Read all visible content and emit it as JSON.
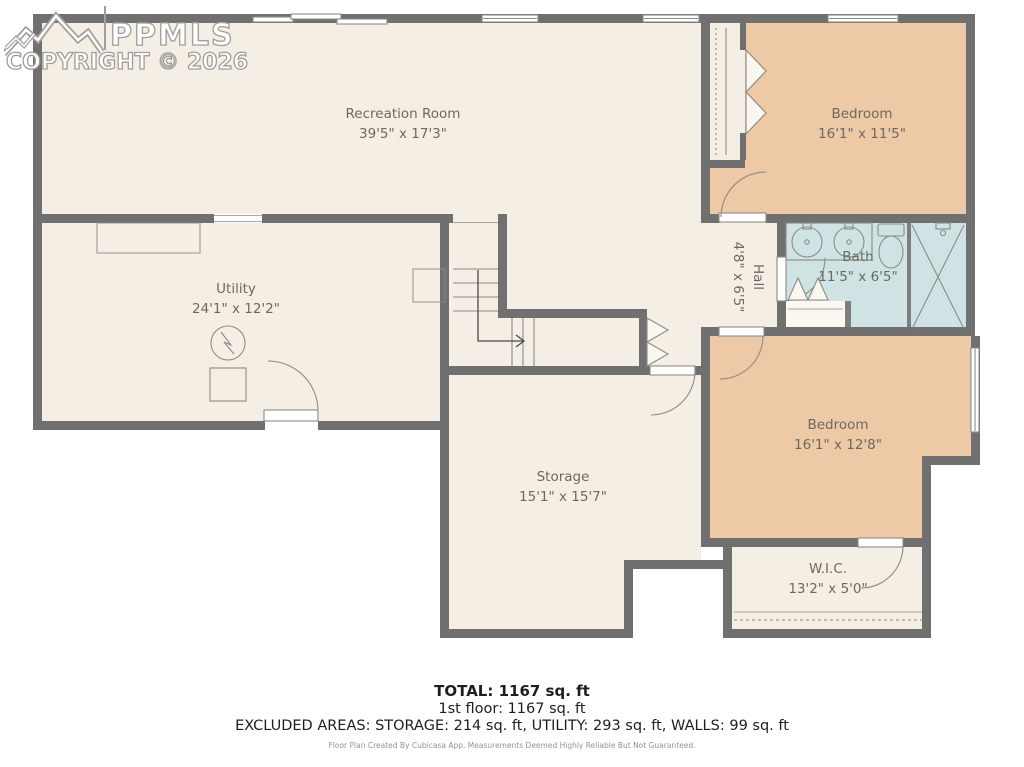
{
  "watermark": {
    "logo_icon": "mountain-peaks-icon",
    "brand": "PPMLS",
    "copyright": "COPYRIGHT © 2026"
  },
  "floor_plan": {
    "rooms": [
      {
        "name": "Recreation Room",
        "dims": "39'5\" x 17'3\""
      },
      {
        "name": "Bedroom",
        "dims": "16'1\" x 11'5\""
      },
      {
        "name": "Utility",
        "dims": "24'1\" x 12'2\""
      },
      {
        "name": "Hall",
        "dims": "4'8\" x 6'5\""
      },
      {
        "name": "Bath",
        "dims": "11'5\" x 6'5\""
      },
      {
        "name": "Bedroom",
        "dims": "16'1\" x 12'8\""
      },
      {
        "name": "Storage",
        "dims": "15'1\" x 15'7\""
      },
      {
        "name": "W.I.C.",
        "dims": "13'2\" x 5'0\""
      }
    ],
    "fixture_icons": [
      "staircase-with-up-arrow",
      "double-sink-vanity",
      "toilet",
      "shower-stall",
      "water-heater-icon",
      "furnace-icon",
      "bifold-closet-doors",
      "window",
      "door-swing"
    ]
  },
  "summary": {
    "total": "TOTAL: 1167 sq. ft",
    "floor": "1st floor: 1167 sq. ft",
    "excluded": "EXCLUDED AREAS: STORAGE: 214 sq. ft, UTILITY: 293 sq. ft, WALLS: 99 sq. ft",
    "disclaimer": "Floor Plan Created By Cubicasa App. Measurements Deemed Highly Reliable But Not Guaranteed."
  },
  "colors": {
    "wall": "#707070",
    "room_fill": "#f4eee5",
    "bedroom_fill": "#edc9a5",
    "bath_fill": "#cfe3e5",
    "label_text": "#6d6962"
  }
}
